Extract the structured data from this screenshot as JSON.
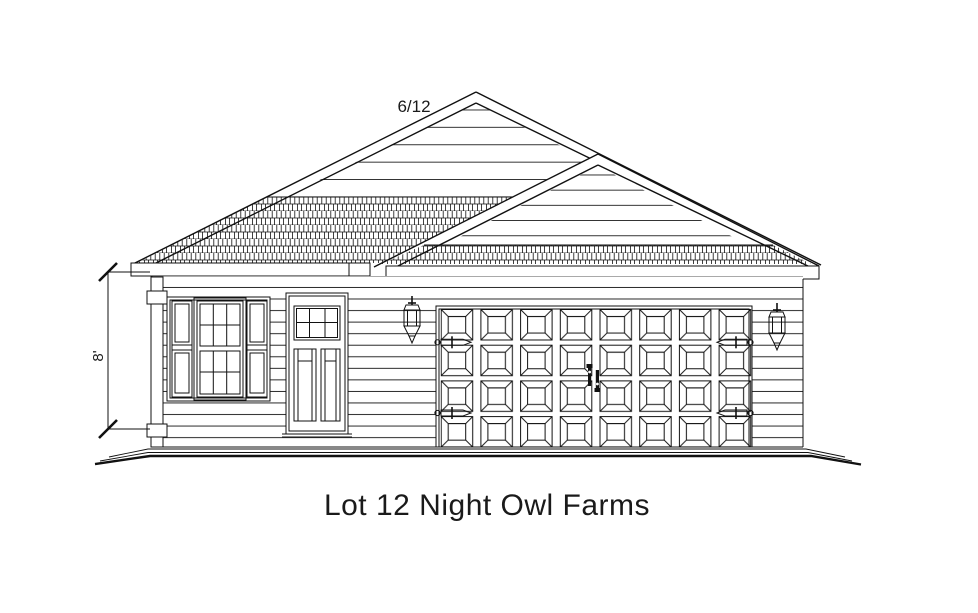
{
  "drawing": {
    "title": "Lot 12 Night Owl Farms",
    "labels": {
      "roof_pitch": "6/12",
      "wall_height": "8'"
    },
    "colors": {
      "line": "#111111",
      "background": "#ffffff"
    },
    "components": {
      "view": "front-elevation",
      "roof": {
        "gables": 2,
        "pitch": "6/12",
        "covering": "shingles"
      },
      "wall_height_dimension": "8'",
      "triple_window": {
        "side_sashes": 2,
        "center_grid_cols": 3,
        "center_grid_rows": 2
      },
      "entry_door": {
        "lite_grid_cols": 3,
        "lite_grid_rows": 2,
        "panels": 2
      },
      "garage_door": {
        "panel_columns": 8,
        "panel_rows": 4,
        "strap_hinges": 4,
        "handles": 2
      },
      "coach_lamps": 2
    }
  }
}
